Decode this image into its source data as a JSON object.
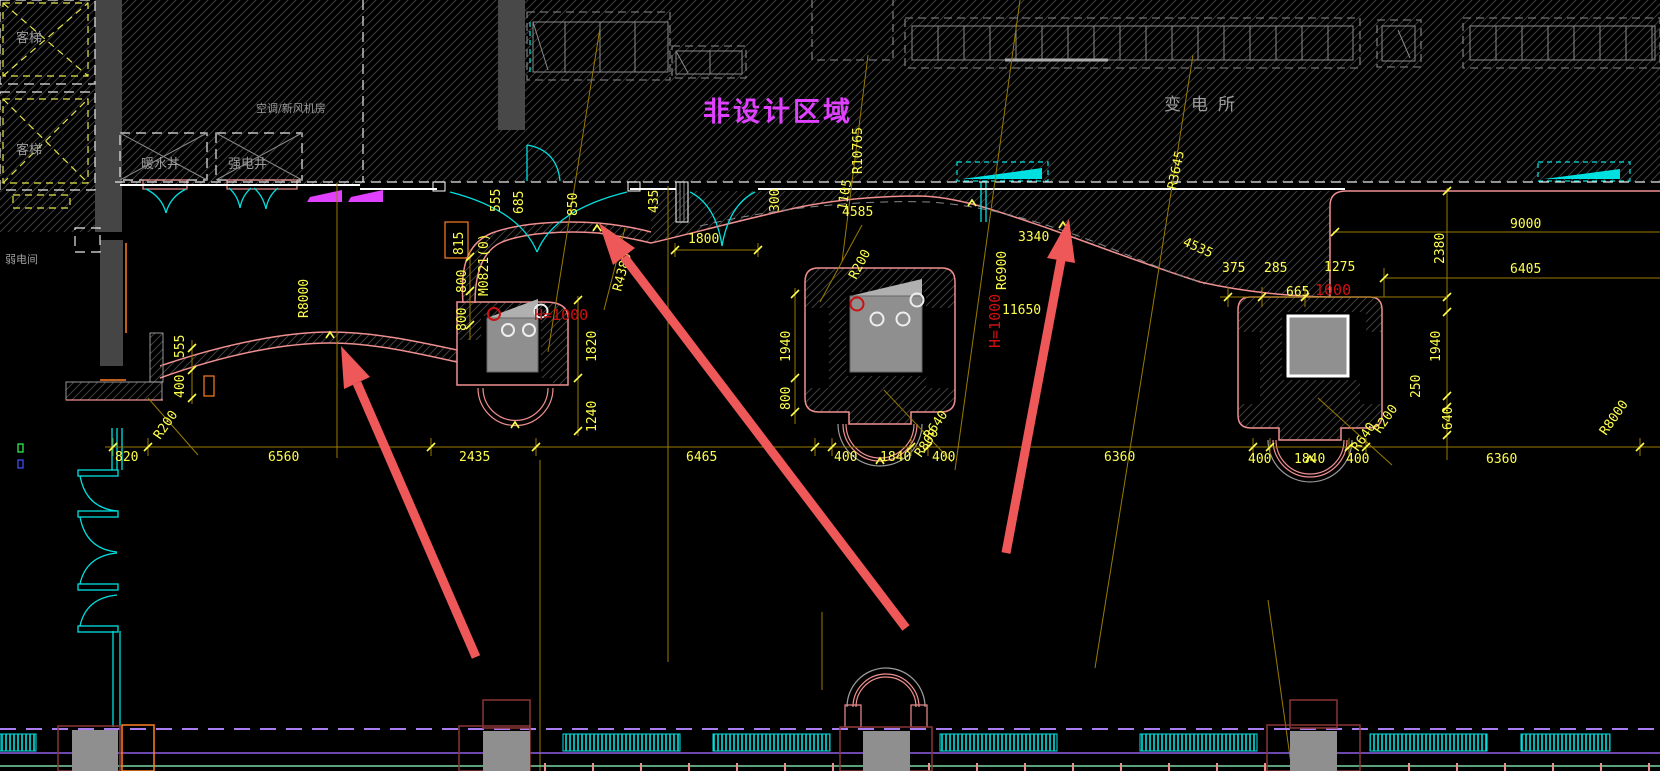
{
  "drawing": {
    "labels": {
      "elevator_upper": "客梯",
      "elevator_lower": "客梯",
      "weak_power_room": "弱电间",
      "ahu_room": "空调/新风机房",
      "hot_water_shaft": "暖水井",
      "strong_power_shaft": "强电井",
      "non_design_area": "非设计区域",
      "substation": "变电所"
    },
    "dims": {
      "b820": "820",
      "b6560": "6560",
      "b2435": "2435",
      "b6465": "6465",
      "b400_1": "400",
      "b1840_1": "1840",
      "b400_2": "400",
      "b6360_1": "6360",
      "b400_3": "400",
      "b1840_2": "1840",
      "b400_4": "400",
      "b6360_2": "6360",
      "l555": "555",
      "l400": "400",
      "r200_l": "R200",
      "r8000_a": "R8000",
      "d555": "555",
      "d685": "685",
      "d850": "850",
      "d435": "435",
      "d815": "815",
      "d800_1": "800",
      "d800_2": "800",
      "door_tag": "M0821(0)",
      "r4380": "R4380",
      "d1800": "1800",
      "d300": "300",
      "d1105": "1105",
      "d4585": "4585",
      "r200_m": "R200",
      "r10765": "R10765",
      "r3645": "R3645",
      "r6900": "R6900",
      "d3340": "3340",
      "d4535": "4535",
      "d375": "375",
      "d285": "285",
      "d1275": "1275",
      "d665": "665",
      "red1000": "1000",
      "d2380": "2380",
      "d9000": "9000",
      "d6405": "6405",
      "d11650": "11650",
      "h1000_1": "H=1000",
      "d1820": "1820",
      "d1240": "1240",
      "d1940_1": "1940",
      "d800_3": "800",
      "h1000_2": "H=1000",
      "r640_1": "R640",
      "r800_1": "R800",
      "d1940_2": "1940",
      "d250": "250",
      "d640": "640",
      "r200_r": "R200",
      "r640_2": "R640",
      "r8000_b": "R8000"
    },
    "colors": {
      "background": "#000000",
      "hatch_line": "#3e3e3e",
      "dimension_yellow": "#ffff4d",
      "construction_olive": "#9a7b00",
      "wall_pink": "#ef8f8f",
      "deep_red": "#8a3535",
      "detail_red": "#d01010",
      "annotation_arrow": "#ef5858",
      "cyan": "#00e0e0",
      "magenta": "#e040ff",
      "purple_dashed": "#a97ef2",
      "green_line": "#7bd6a2",
      "orange": "#ff7f1f",
      "gray_text": "#9c9c9c"
    }
  }
}
